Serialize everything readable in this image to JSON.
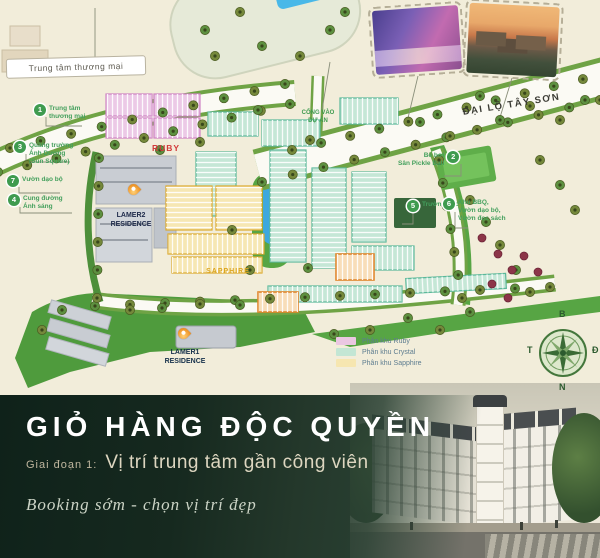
{
  "map": {
    "mall_box_label": "Trung tâm thương mại",
    "avenue_label": "ĐẠI LỘ TÂY SƠN",
    "gate_label": "CỔNG VÀO\nDỰ ÁN",
    "ruby_label": "RUBY",
    "sapphire_label": "SAPPHIRE",
    "residence_2": "LAMER2\nRESIDENCE",
    "residence_1": "LAMER1\nRESIDENCE",
    "callouts": [
      {
        "num": "1",
        "label": "Trung tâm\nthương mại"
      },
      {
        "num": "3",
        "label": "Quảng trường\nÁnh Dương\n(Sun Square)"
      },
      {
        "num": "7",
        "label": "Vườn dạo bộ"
      },
      {
        "num": "4",
        "label": "Cung đường\nÁnh sáng"
      },
      {
        "num": "2",
        "label": "Bể bơi\nSân Pickle Ball"
      },
      {
        "num": "5",
        "label": "Trường học"
      },
      {
        "num": "6",
        "label": "Khu BBQ,\nVườn dạo bộ,\nVườn đọc sách"
      }
    ],
    "legend": {
      "items": [
        {
          "label": "Phân khu Ruby",
          "color": "#eac7e2"
        },
        {
          "label": "Phân khu Crystal",
          "color": "#c3e6d4"
        },
        {
          "label": "Phân khu Sapphire",
          "color": "#f6e6b0"
        }
      ]
    },
    "compass": {
      "n": "B",
      "e": "Đ",
      "s": "N",
      "w": "T"
    },
    "zone_colors": {
      "ruby": "#ecc9e6",
      "crystal": "#c5e7d6",
      "sapphire": "#f6e7b3",
      "accent_orange": "#e0862c"
    }
  },
  "banner": {
    "title": "GIỎ HÀNG ĐỘC QUYỀN",
    "phase_prefix": "Giai đoạn 1:",
    "phase_text": "Vị trí trung tâm gần công viên",
    "tagline": "Booking sớm - chọn vị trí đẹp",
    "colors": {
      "bg_dark": "#0f221a",
      "bg_mid": "#2b4234",
      "title": "#ffffff",
      "subtitle": "#ddd6c0",
      "tagline": "#ccd4c6"
    }
  }
}
